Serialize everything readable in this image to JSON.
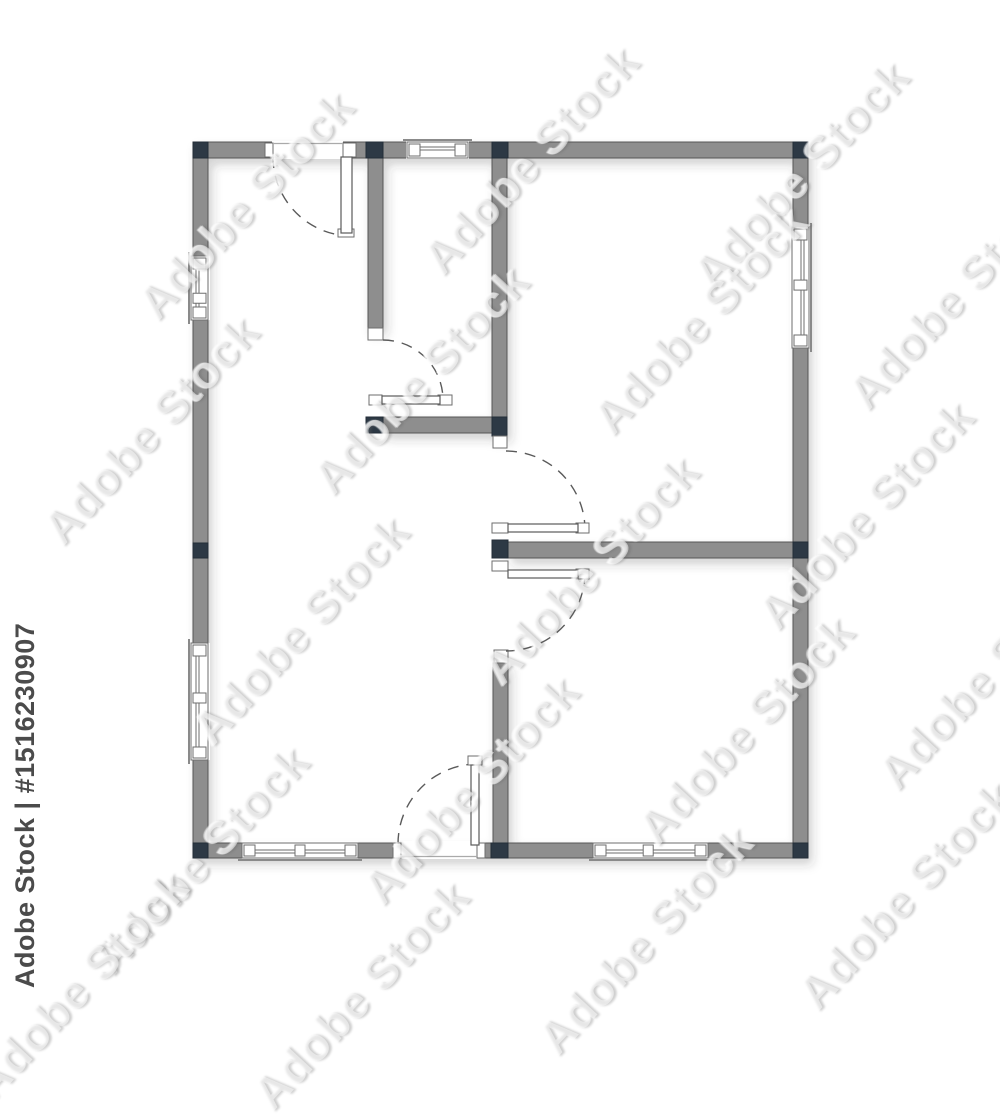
{
  "image": {
    "width": 1000,
    "height": 1000,
    "background": "#ffffff",
    "kind": "architectural floor plan, top view"
  },
  "watermark": {
    "credit_text": "Adobe Stock | #1516230907",
    "tile_text": "Adobe Stock",
    "tile_rotation_deg": -47,
    "credit_color": "#4b4b4b",
    "tile_positions": [
      [
        245,
        205
      ],
      [
        530,
        160
      ],
      [
        800,
        175
      ],
      [
        150,
        430
      ],
      [
        420,
        380
      ],
      [
        700,
        320
      ],
      [
        955,
        295
      ],
      [
        300,
        630
      ],
      [
        590,
        570
      ],
      [
        865,
        515
      ],
      [
        200,
        860
      ],
      [
        470,
        790
      ],
      [
        745,
        730
      ],
      [
        985,
        675
      ],
      [
        360,
        995
      ],
      [
        645,
        940
      ],
      [
        905,
        895
      ],
      [
        80,
        985
      ]
    ]
  },
  "palette": {
    "wall_fill": "#8e8e8e",
    "wall_stroke": "#565656",
    "post_fill": "#2d3945",
    "post_stroke": "#232d38",
    "opening_stroke": "#6e6e6e",
    "sill_stroke": "#8a8a8a",
    "arc_color": "#5a5a5a",
    "white": "#ffffff",
    "shadow_color": "#30343a"
  },
  "floor_plan": {
    "walls": [
      {
        "name": "outer-wall-top",
        "x": 193,
        "y": 142,
        "w": 615,
        "h": 16
      },
      {
        "name": "outer-wall-bottom",
        "x": 193,
        "y": 843,
        "w": 615,
        "h": 15
      },
      {
        "name": "outer-wall-left",
        "x": 193,
        "y": 142,
        "w": 15,
        "h": 716
      },
      {
        "name": "outer-wall-right",
        "x": 793,
        "y": 142,
        "w": 15,
        "h": 716
      },
      {
        "name": "interior-wall-closet-left",
        "x": 368,
        "y": 158,
        "w": 15,
        "h": 171
      },
      {
        "name": "interior-wall-hall-right",
        "x": 492,
        "y": 158,
        "w": 15,
        "h": 278
      },
      {
        "name": "interior-wall-closet-bottom",
        "x": 383,
        "y": 417,
        "w": 109,
        "h": 16
      },
      {
        "name": "interior-wall-center",
        "x": 508,
        "y": 542,
        "w": 285,
        "h": 16
      },
      {
        "name": "interior-wall-lower",
        "x": 493,
        "y": 663,
        "w": 15,
        "h": 180
      }
    ],
    "cutouts": [
      {
        "name": "opening-top-door",
        "x": 272,
        "y": 141,
        "w": 71,
        "h": 18
      },
      {
        "name": "opening-top-window",
        "x": 406,
        "y": 141,
        "w": 63,
        "h": 18
      },
      {
        "name": "opening-left-upper-window",
        "x": 190,
        "y": 256,
        "w": 20,
        "h": 64
      },
      {
        "name": "opening-left-lower-window",
        "x": 190,
        "y": 643,
        "w": 20,
        "h": 117
      },
      {
        "name": "opening-right-window",
        "x": 790,
        "y": 227,
        "w": 20,
        "h": 121
      },
      {
        "name": "opening-bottom-left-window",
        "x": 242,
        "y": 841,
        "w": 116,
        "h": 18
      },
      {
        "name": "opening-bottom-right-window",
        "x": 593,
        "y": 841,
        "w": 115,
        "h": 18
      },
      {
        "name": "opening-entrance-door",
        "x": 401,
        "y": 841,
        "w": 76,
        "h": 18
      }
    ],
    "posts": [
      {
        "name": "post-top-left",
        "x": 193,
        "y": 142,
        "w": 15,
        "h": 16
      },
      {
        "name": "post-top-wall-a",
        "x": 366,
        "y": 142,
        "w": 17,
        "h": 16
      },
      {
        "name": "post-top-wall-b",
        "x": 492,
        "y": 142,
        "w": 16,
        "h": 16
      },
      {
        "name": "post-top-right",
        "x": 793,
        "y": 142,
        "w": 15,
        "h": 16
      },
      {
        "name": "post-left-mid",
        "x": 193,
        "y": 543,
        "w": 15,
        "h": 15
      },
      {
        "name": "post-right-mid",
        "x": 793,
        "y": 542,
        "w": 15,
        "h": 16
      },
      {
        "name": "post-closet-bottom-left",
        "x": 366,
        "y": 417,
        "w": 17,
        "h": 16
      },
      {
        "name": "post-closet-bottom-right",
        "x": 492,
        "y": 417,
        "w": 15,
        "h": 19
      },
      {
        "name": "post-center-stub",
        "x": 492,
        "y": 540,
        "w": 16,
        "h": 18
      },
      {
        "name": "post-bottom-left",
        "x": 193,
        "y": 843,
        "w": 15,
        "h": 15
      },
      {
        "name": "post-bottom-wall-e",
        "x": 491,
        "y": 843,
        "w": 17,
        "h": 15
      },
      {
        "name": "post-bottom-right",
        "x": 793,
        "y": 843,
        "w": 15,
        "h": 15
      }
    ],
    "jambs": [
      {
        "name": "jamb-top-door-left",
        "x": 265,
        "y": 143,
        "w": 8,
        "h": 14
      },
      {
        "name": "jamb-wall-a-end",
        "x": 368,
        "y": 328,
        "w": 15,
        "h": 12
      },
      {
        "name": "jamb-wall-b-end",
        "x": 493,
        "y": 436,
        "w": 14,
        "h": 12
      },
      {
        "name": "jamb-wall-e-top",
        "x": 494,
        "y": 650,
        "w": 14,
        "h": 13
      },
      {
        "name": "jamb-entrance-left",
        "x": 393,
        "y": 843,
        "w": 8,
        "h": 15
      },
      {
        "name": "jamb-entrance-right",
        "x": 477,
        "y": 843,
        "w": 8,
        "h": 15
      }
    ],
    "windows": [
      {
        "name": "window-left-upper",
        "x": 191,
        "y": 256,
        "w": 17,
        "h": 64,
        "dir": "v",
        "outer": "left",
        "mullion": 0.66
      },
      {
        "name": "window-left-lower",
        "x": 191,
        "y": 643,
        "w": 17,
        "h": 117,
        "dir": "v",
        "outer": "left",
        "mullion": 0.47
      },
      {
        "name": "window-right",
        "x": 792,
        "y": 227,
        "w": 17,
        "h": 121,
        "dir": "v",
        "outer": "right",
        "mullion": 0.48
      },
      {
        "name": "window-top",
        "x": 407,
        "y": 142,
        "w": 61,
        "h": 16,
        "dir": "h",
        "outer": "top",
        "mullion": null
      },
      {
        "name": "window-bottom-left",
        "x": 242,
        "y": 843,
        "w": 116,
        "h": 15,
        "dir": "h",
        "outer": "bottom",
        "mullion": 0.5
      },
      {
        "name": "window-bottom-right",
        "x": 593,
        "y": 843,
        "w": 115,
        "h": 15,
        "dir": "h",
        "outer": "bottom",
        "mullion": 0.48
      }
    ],
    "doors": [
      {
        "name": "door-top-left",
        "leaf": {
          "x": 341,
          "y": 157,
          "w": 11,
          "h": 76
        },
        "caps": [
          {
            "x": 343,
            "y": 143,
            "w": 13,
            "h": 14
          },
          {
            "x": 338,
            "y": 229,
            "w": 16,
            "h": 8
          }
        ],
        "arc": "M 273,157 A 79,79 0 0 0 352,236"
      },
      {
        "name": "door-closet",
        "leaf": {
          "x": 382,
          "y": 396,
          "w": 58,
          "h": 8
        },
        "caps": [
          {
            "x": 369,
            "y": 395,
            "w": 13,
            "h": 10
          },
          {
            "x": 438,
            "y": 395,
            "w": 14,
            "h": 10
          }
        ],
        "arc": "M 383,340 A 60,60 0 0 1 443,400"
      },
      {
        "name": "door-center-upper",
        "leaf": {
          "x": 508,
          "y": 524,
          "w": 70,
          "h": 8
        },
        "caps": [
          {
            "x": 492,
            "y": 523,
            "w": 16,
            "h": 10
          },
          {
            "x": 576,
            "y": 523,
            "w": 13,
            "h": 10
          }
        ],
        "arc": "M 506,451 A 79,79 0 0 1 585,529"
      },
      {
        "name": "door-center-lower",
        "leaf": {
          "x": 508,
          "y": 570,
          "w": 70,
          "h": 8
        },
        "caps": [
          {
            "x": 492,
            "y": 561,
            "w": 16,
            "h": 10
          },
          {
            "x": 576,
            "y": 569,
            "w": 13,
            "h": 10
          }
        ],
        "arc": "M 585,573 A 79,79 0 0 1 506,651"
      },
      {
        "name": "door-entrance",
        "leaf": {
          "x": 471,
          "y": 765,
          "w": 8,
          "h": 80
        },
        "caps": [
          {
            "x": 468,
            "y": 756,
            "w": 14,
            "h": 9
          }
        ],
        "arc": "M 398,844 A 80,80 0 0 1 474,764"
      }
    ],
    "thresholds": [
      {
        "name": "threshold-entrance",
        "x1": 401,
        "y1": 856.5,
        "x2": 477,
        "y2": 856.5
      },
      {
        "name": "threshold-top-door",
        "x1": 273,
        "y1": 143.5,
        "x2": 343,
        "y2": 143.5
      }
    ]
  }
}
